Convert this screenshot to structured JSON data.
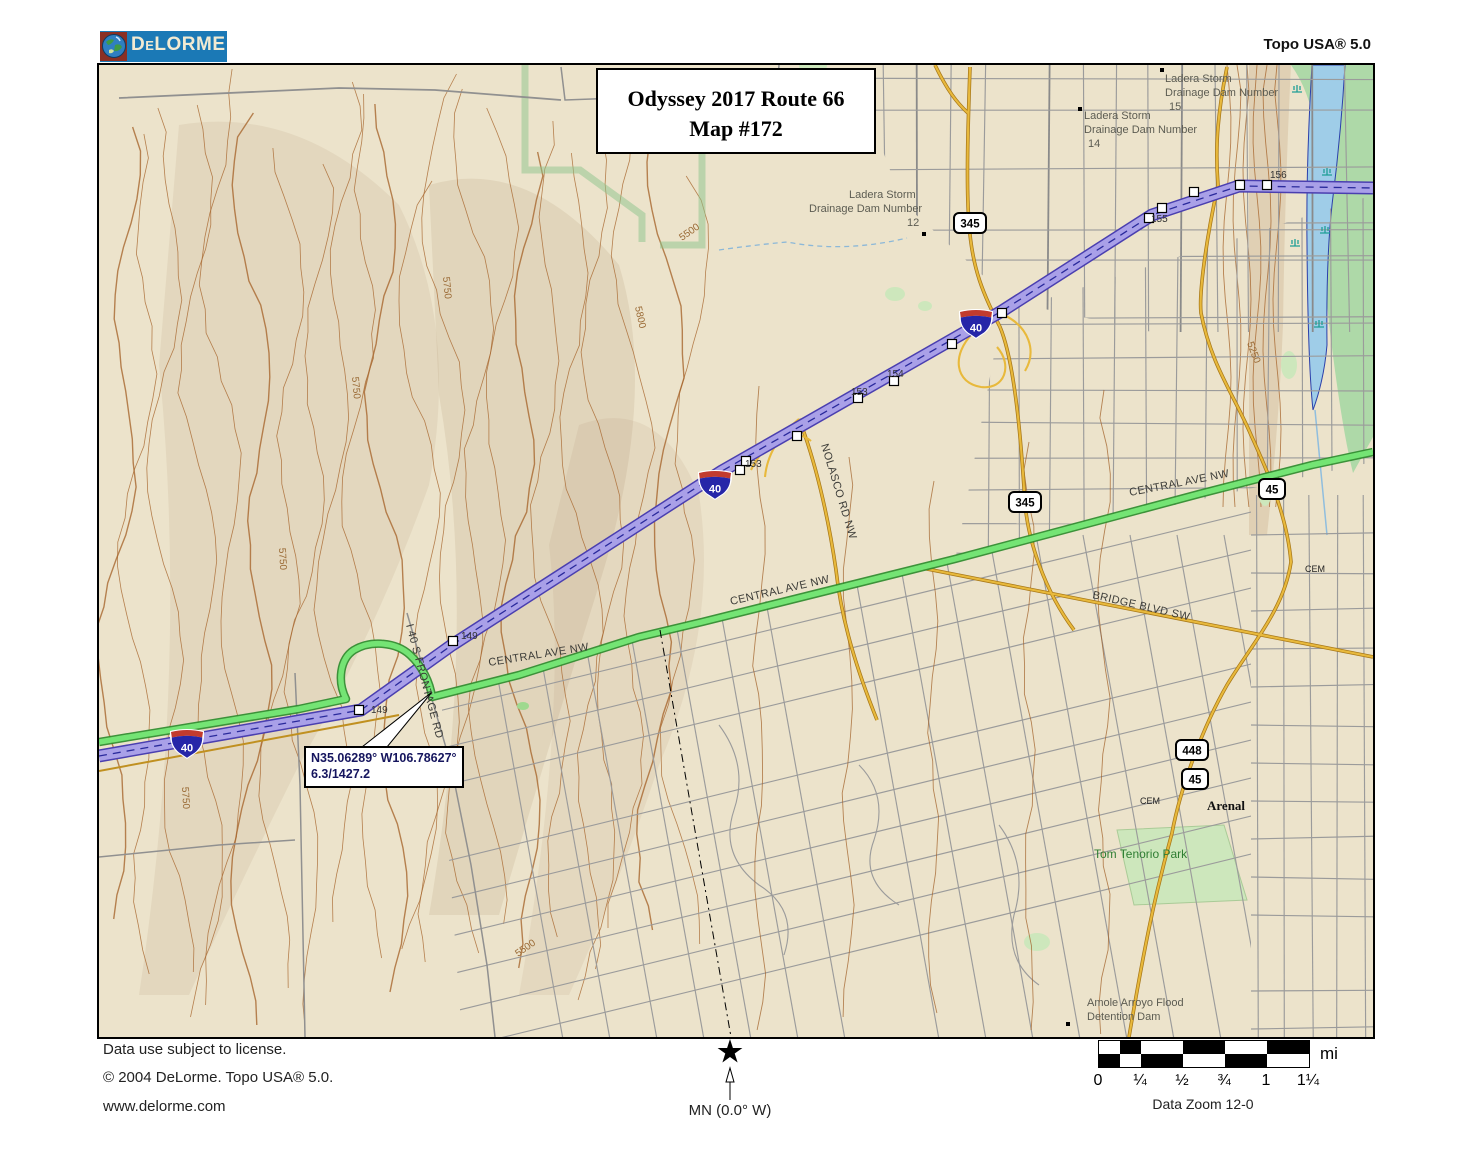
{
  "header": {
    "logo": "DeLORME",
    "product": "Topo USA® 5.0"
  },
  "map_title": {
    "line1": "Odyssey 2017 Route 66",
    "line2": "Map #172"
  },
  "callout": {
    "line1": "N35.06289° W106.78627°",
    "line2": "6.3/1427.2"
  },
  "footer": {
    "license": "Data use subject to license.",
    "copyright": "© 2004 DeLorme. Topo USA® 5.0.",
    "website": "www.delorme.com",
    "north_label": "MN (0.0° W)",
    "scale_units": "mi",
    "scale_ticks": [
      "0",
      "¼",
      "½",
      "¾",
      "1",
      "1¼"
    ],
    "zoom_label": "Data Zoom 12-0"
  },
  "colors": {
    "logo_blue": "#1b79b6",
    "terrain": "#ece3cb",
    "contour": "#a8672e",
    "interstate_fill": "#a9a0e8",
    "interstate_casing": "#4a3fb0",
    "route_highlight": "#74e474",
    "route_casing": "#2e8b2e",
    "major_road": "#e8b93c",
    "water": "#9fcde8",
    "riparian": "#aed9a8"
  },
  "map_labels": [
    {
      "t": "Ladera Storm",
      "x": 1066,
      "y": 17,
      "c": "dam"
    },
    {
      "t": "Drainage Dam Number",
      "x": 1066,
      "y": 31,
      "c": "dam"
    },
    {
      "t": "15",
      "x": 1070,
      "y": 45,
      "c": "dam"
    },
    {
      "t": "Ladera Storm",
      "x": 985,
      "y": 54,
      "c": "dam"
    },
    {
      "t": "Drainage Dam Number",
      "x": 985,
      "y": 68,
      "c": "dam"
    },
    {
      "t": "14",
      "x": 989,
      "y": 82,
      "c": "dam"
    },
    {
      "t": "Ladera Storm",
      "x": 750,
      "y": 133,
      "c": "dam"
    },
    {
      "t": "Drainage Dam Number",
      "x": 710,
      "y": 147,
      "c": "dam"
    },
    {
      "t": "12",
      "x": 808,
      "y": 161,
      "c": "dam"
    },
    {
      "t": "Amole Arroyo Flood",
      "x": 988,
      "y": 941,
      "c": "dam"
    },
    {
      "t": "Detention Dam",
      "x": 988,
      "y": 955,
      "c": "dam"
    },
    {
      "t": "CENTRAL AVE NW",
      "x": 390,
      "y": 601,
      "r": -9,
      "c": "road"
    },
    {
      "t": "CENTRAL AVE NW",
      "x": 632,
      "y": 540,
      "r": -13,
      "c": "road"
    },
    {
      "t": "CENTRAL AVE NW",
      "x": 1031,
      "y": 431,
      "r": -11,
      "c": "road"
    },
    {
      "t": "BRIDGE BLVD SW",
      "x": 993,
      "y": 533,
      "r": 13,
      "c": "road"
    },
    {
      "t": "NOLASCO RD NW",
      "x": 722,
      "y": 380,
      "r": 73,
      "c": "road"
    },
    {
      "t": "I 40 S FRONTAGE RD",
      "x": 307,
      "y": 560,
      "r": 75,
      "c": "road"
    },
    {
      "t": "5500",
      "x": 583,
      "y": 176,
      "r": -35,
      "c": "elev"
    },
    {
      "t": "5750",
      "x": 344,
      "y": 212,
      "r": 85,
      "c": "elev"
    },
    {
      "t": "5800",
      "x": 536,
      "y": 242,
      "r": 78,
      "c": "elev"
    },
    {
      "t": "5750",
      "x": 253,
      "y": 312,
      "r": 85,
      "c": "elev"
    },
    {
      "t": "5250",
      "x": 1148,
      "y": 278,
      "r": 70,
      "c": "elev"
    },
    {
      "t": "5750",
      "x": 180,
      "y": 483,
      "r": 87,
      "c": "elev"
    },
    {
      "t": "5750",
      "x": 83,
      "y": 722,
      "r": 87,
      "c": "elev"
    },
    {
      "t": "5500",
      "x": 419,
      "y": 892,
      "r": -35,
      "c": "elev"
    },
    {
      "t": "Arenal",
      "x": 1108,
      "y": 745,
      "c": "place"
    },
    {
      "t": "CEM",
      "x": 1041,
      "y": 739,
      "c": "small"
    },
    {
      "t": "CEM",
      "x": 1206,
      "y": 507,
      "c": "small"
    },
    {
      "t": "Tom Tenorio Park",
      "x": 995,
      "y": 793,
      "c": "park"
    }
  ],
  "shields": {
    "interstate": [
      {
        "n": "40",
        "x": 88,
        "y": 679
      },
      {
        "n": "40",
        "x": 616,
        "y": 420
      },
      {
        "n": "40",
        "x": 877,
        "y": 259
      }
    ],
    "state": [
      {
        "n": "345",
        "x": 871,
        "y": 158
      },
      {
        "n": "345",
        "x": 926,
        "y": 437
      },
      {
        "n": "45",
        "x": 1173,
        "y": 424
      },
      {
        "n": "448",
        "x": 1093,
        "y": 685
      },
      {
        "n": "45",
        "x": 1096,
        "y": 714
      }
    ]
  },
  "mile_markers": {
    "squares": [
      [
        260,
        645
      ],
      [
        354,
        576
      ],
      [
        641,
        405
      ],
      [
        647,
        396
      ],
      [
        698,
        371
      ],
      [
        759,
        333
      ],
      [
        795,
        316
      ],
      [
        853,
        279
      ],
      [
        903,
        248
      ],
      [
        1050,
        153
      ],
      [
        1063,
        143
      ],
      [
        1095,
        127
      ],
      [
        1141,
        120
      ],
      [
        1168,
        120
      ]
    ],
    "labels": [
      {
        "t": "149",
        "x": 272,
        "y": 648
      },
      {
        "t": "149",
        "x": 362,
        "y": 574
      },
      {
        "t": "153",
        "x": 646,
        "y": 402
      },
      {
        "t": "153",
        "x": 752,
        "y": 330
      },
      {
        "t": "154",
        "x": 788,
        "y": 312
      },
      {
        "t": "155",
        "x": 1052,
        "y": 157
      },
      {
        "t": "156",
        "x": 1171,
        "y": 113
      }
    ]
  },
  "dam_dots": [
    [
      1063,
      5
    ],
    [
      981,
      44
    ],
    [
      825,
      169
    ],
    [
      969,
      959
    ]
  ],
  "marsh_symbols": [
    [
      1198,
      27
    ],
    [
      1228,
      110
    ],
    [
      1196,
      181
    ],
    [
      1226,
      168
    ],
    [
      1220,
      262
    ]
  ]
}
